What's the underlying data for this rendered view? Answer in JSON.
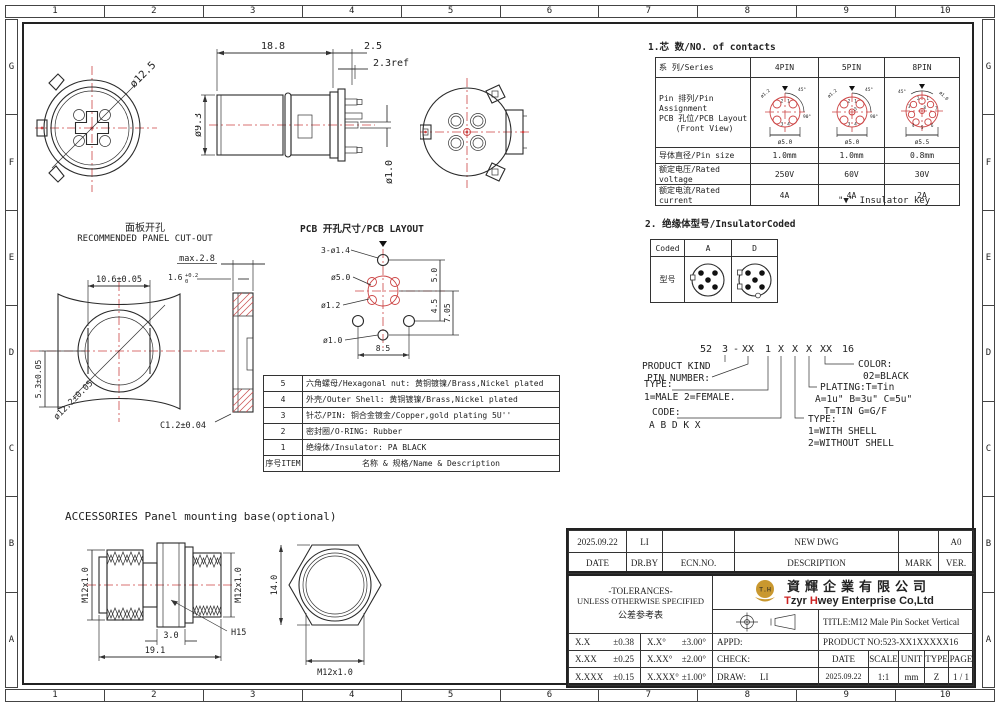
{
  "border": {
    "columns": [
      "1",
      "2",
      "3",
      "4",
      "5",
      "6",
      "7",
      "8",
      "9",
      "10"
    ],
    "rows": [
      "G",
      "F",
      "E",
      "D",
      "C",
      "B",
      "A"
    ]
  },
  "views": {
    "front": {
      "dia": "ø12.5"
    },
    "side": {
      "len": "18.8",
      "pin_len": "2.5",
      "ref": "2.3ref",
      "body_dia": "ø9.3",
      "pin_dia": "ø1.0"
    },
    "panel": {
      "title_cn": "面板开孔",
      "title_en": "RECOMMENDED PANEL CUT-OUT",
      "width": "10.6±0.05",
      "max_t": "max.2.8",
      "t_main": "1.6",
      "t_sup": "+0.2",
      "t_sub": "0",
      "half": "5.3±0.05",
      "dia": "ø12.2±0.05",
      "chamfer": "C1.2±0.04"
    },
    "pcb": {
      "title": "PCB 开孔尺寸/PCB LAYOUT",
      "holes": "3-ø1.4",
      "bcd": "ø5.0",
      "pin": "ø1.2",
      "center": "ø1.0",
      "v1": "5.0",
      "v2": "4.5",
      "v3": "7.05",
      "width": "8.5"
    },
    "acc": {
      "title": "ACCESSORIES Panel mounting base(optional)",
      "thread_l": "M12x1.0",
      "thread_r": "M12x1.0",
      "hex_w": "3.0",
      "len": "19.1",
      "hex": "H15",
      "height": "14.0",
      "thread_f": "M12x1.0"
    }
  },
  "contacts": {
    "heading": "1.芯 数/NO. of contacts",
    "series_label": "系 列/Series",
    "cols": [
      "4PIN",
      "5PIN",
      "8PIN"
    ],
    "pin_label_1": "Pin 排列/Pin Assignment",
    "pin_label_2": "PCB 孔位/PCB Layout",
    "pin_label_3": "(Front View)",
    "rows": [
      {
        "label": "导体直径/Pin size",
        "v": [
          "1.0mm",
          "1.0mm",
          "0.8mm"
        ]
      },
      {
        "label": "额定电压/Rated voltage",
        "v": [
          "250V",
          "60V",
          "30V"
        ]
      },
      {
        "label": "额定电流/Rated current",
        "v": [
          "4A",
          "4A",
          "2A"
        ]
      }
    ],
    "key_note": "\"▼\" Insulator key",
    "d4": {
      "bcd": "ø5.0",
      "pin": "ø1.2",
      "a1": "45°",
      "a2": "90°",
      "pins": [
        "1",
        "2",
        "3",
        "4"
      ]
    },
    "d5": {
      "bcd": "ø5.0",
      "pin": "ø1.2",
      "a1": "45°",
      "a2": "90°",
      "pins": [
        "1",
        "2",
        "3",
        "4",
        "5"
      ]
    },
    "d8": {
      "bcd": "ø5.5",
      "pin": "ø1.0",
      "a1": "45°",
      "pins": [
        "1",
        "2",
        "3",
        "4",
        "5",
        "6",
        "7",
        "8"
      ]
    }
  },
  "insulator": {
    "heading": "2. 绝缘体型号/InsulatorCoded",
    "coded": "Coded",
    "model": "型号",
    "col_a": "A",
    "col_d": "D"
  },
  "part_number": {
    "code": [
      "52",
      "3",
      "-",
      "XX",
      "1",
      "X",
      "X",
      "X",
      "XX",
      "16"
    ],
    "product_kind": "PRODUCT KIND",
    "pin_number": "PIN NUMBER:",
    "type1": "TYPE:",
    "type1_v": "1=MALE  2=FEMALE.",
    "code_label": "CODE:",
    "code_v": "A B D K X",
    "type2": "TYPE:",
    "type2_v1": "1=WITH SHELL",
    "type2_v2": "2=WITHOUT SHELL",
    "plating": "PLATING:T=Tin",
    "plating_v1": "A=1u\"  B=3u\"  C=5u\"",
    "plating_v2": "T=TIN  G=G/F",
    "color": "COLOR:",
    "color_v": "02=BLACK"
  },
  "parts": {
    "rows": [
      {
        "item": "5",
        "desc": "六角螺母/Hexagonal nut: 黄铜镀镍/Brass,Nickel plated"
      },
      {
        "item": "4",
        "desc": "外壳/Outer Shell: 黄铜镀镍/Brass,Nickel plated"
      },
      {
        "item": "3",
        "desc": "针芯/PIN: 铜合金镀金/Copper,gold plating 5U''"
      },
      {
        "item": "2",
        "desc": "密封圈/O-RING: Rubber"
      },
      {
        "item": "1",
        "desc": "绝缘体/Insulator: PA BLACK"
      }
    ],
    "f_item": "序号ITEM",
    "f_desc": "名称 & 规格/Name & Description"
  },
  "tb": {
    "date": "2025.09.22",
    "drby": "LI",
    "ecn": "",
    "desc": "NEW DWG",
    "mark": "",
    "ver": "A0",
    "h_date": "DATE",
    "h_drby": "DR.BY",
    "h_ecn": "ECN.NO.",
    "h_desc": "DESCRIPTION",
    "h_mark": "MARK",
    "h_ver": "VER.",
    "tol1": "-TOLERANCES-",
    "tol2": "UNLESS OTHERWISE SPECIFIED",
    "tol3": "公差参考表",
    "t_rows": [
      {
        "a": "X.X",
        "b": "±0.38",
        "c": "X.X°",
        "d": "±3.00°"
      },
      {
        "a": "X.XX",
        "b": "±0.25",
        "c": "X.XX°",
        "d": "±2.00°"
      },
      {
        "a": "X.XXX",
        "b": "±0.15",
        "c": "X.XXX°",
        "d": "±1.00°"
      }
    ],
    "logo": "T.H",
    "co_cn": "資輝企業有限公司",
    "co_t": "T",
    "co_zyr": "zyr ",
    "co_h": "H",
    "co_rest": "wey Enterprise Co,Ltd",
    "title": "TITLE:M12 Male Pin Socket Vertical",
    "appd": "APPD:",
    "check": "CHECK:",
    "draw": "DRAW:",
    "draw_v": "LI",
    "product_no": "PRODUCT NO:523-XX1XXXXX16",
    "i_date": "DATE",
    "i_scale": "SCALE",
    "i_unit": "UNIT",
    "i_type": "TYPE",
    "i_page": "PAGE",
    "v_date": "2025.09.22",
    "v_scale": "1:1",
    "v_unit": "mm",
    "v_type": "Z",
    "v_page": "1 / 1"
  }
}
